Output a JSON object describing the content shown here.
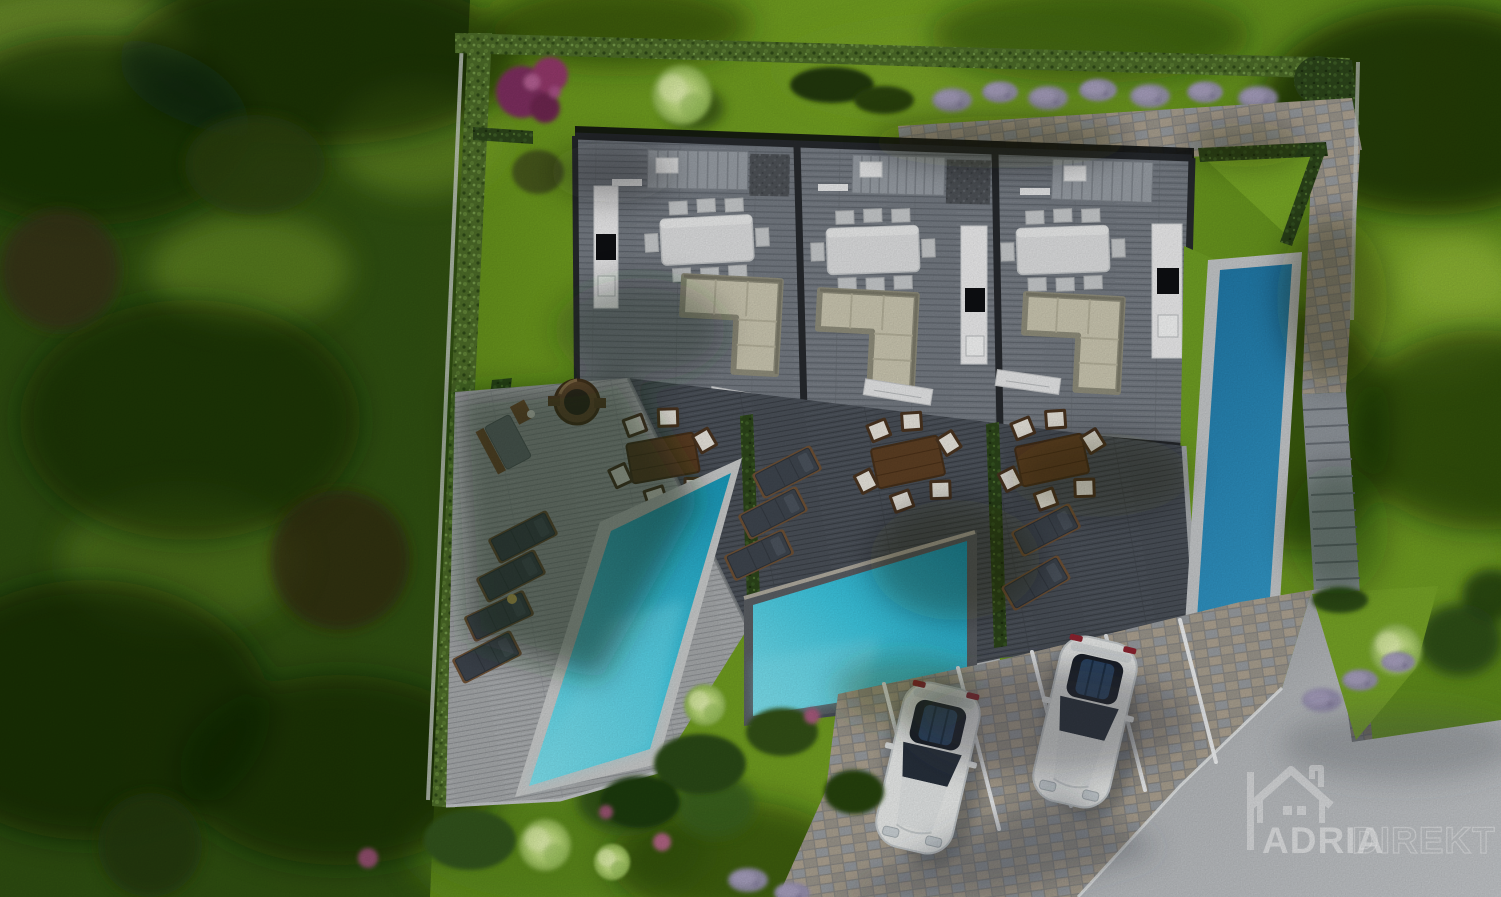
{
  "image": {
    "type": "aerial-3d-architectural-rendering",
    "subject": "Top view of a modern residential complex: three attached villa units with open-plan interiors, wooden sun decks, three swimming pools, landscaped gardens, parking with two white cars and an access road"
  },
  "watermark": {
    "icon": "house-logo-icon",
    "brand_primary": "ADRIA",
    "brand_secondary": "DIREKT"
  },
  "site": {
    "building_units": 3,
    "unit_features": [
      "staircase",
      "kitchen with cooktop and sink",
      "dining table with 8 chairs",
      "L-shaped sofa"
    ],
    "pools": {
      "count": 3,
      "front_pool_color": "#3ec7e0",
      "side_pool_color": "#2b86b8"
    },
    "terrace_furniture": {
      "fire_pit": 1,
      "garden_bench": 1,
      "outdoor_dining_sets": 3,
      "sun_loungers": 9
    },
    "parking": {
      "stalls": 5,
      "cars": 2,
      "car_color": "white"
    },
    "landscape_elements": [
      "boundary hedges",
      "purple flowering shrub",
      "round ornamental tree",
      "lavender bushes",
      "ornamental grass balls",
      "lawns",
      "paved path",
      "outdoor staircase",
      "cobblestone parking",
      "asphalt road"
    ]
  },
  "palette": {
    "lawn_sun": "#7ca326",
    "lawn_shadow": "#24420c",
    "forest": "#203a0d",
    "hedge": "#4c6b28",
    "deck_light": "#a6a9ab",
    "deck_dark": "#474d55",
    "floor": "#737981",
    "wall": "#26292d",
    "kitchen": "#ececed",
    "sofa": "#cbc7b1",
    "wood": "#5d3f23",
    "pool_bright": "#3ec7e0",
    "pool_deep": "#2b86b8",
    "cobble": "#9a958b",
    "asphalt": "#b6b9bc",
    "car": "#e9ebea",
    "marking": "#eef0f1",
    "watermark_white": "#ffffff"
  }
}
